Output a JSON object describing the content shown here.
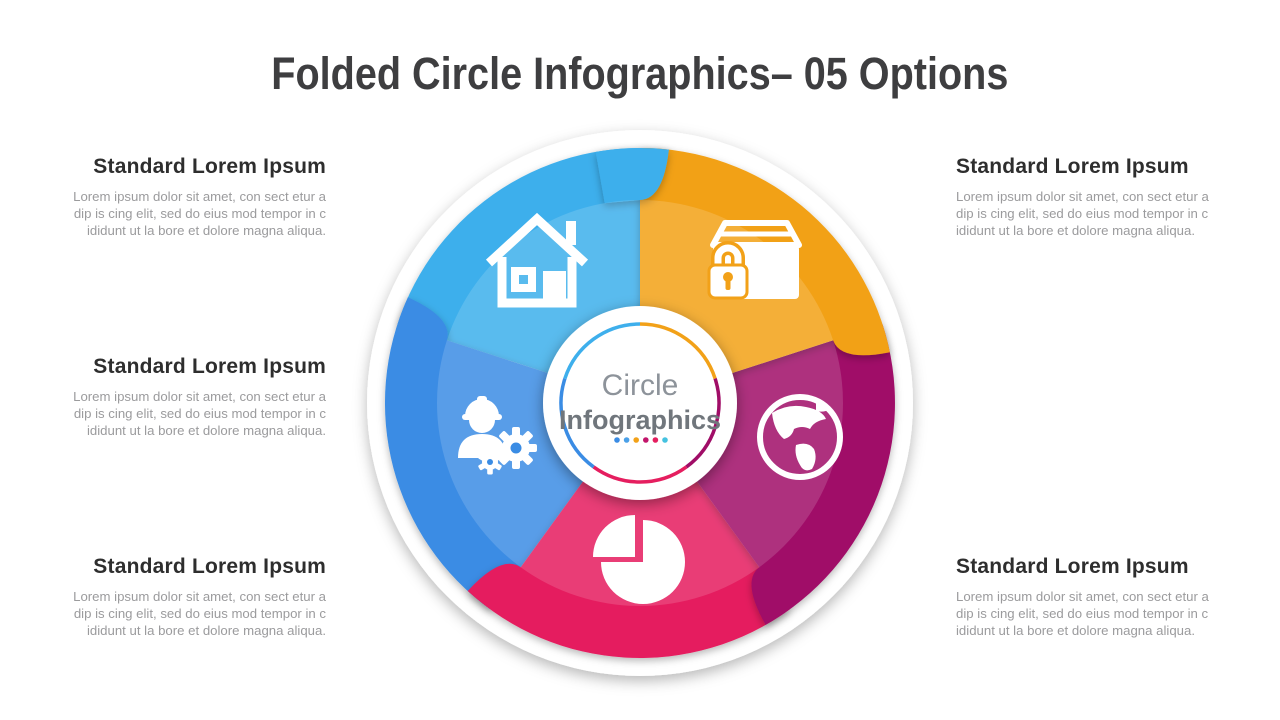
{
  "slide": {
    "title": "Folded Circle Infographics– 05 Options"
  },
  "center": {
    "line1": "Circle",
    "line2": "Infographics"
  },
  "colors": {
    "lightblue": "#3eafec",
    "orange": "#f2a118",
    "magenta": "#a00d67",
    "crimson": "#e51e5f",
    "blue": "#3a8ce4",
    "white": "#ffffff"
  },
  "dots": [
    "#3a8ce4",
    "#4aa0e8",
    "#f2a118",
    "#c2156b",
    "#e51e5f",
    "#45c2e0"
  ],
  "options": [
    {
      "icon": "house-icon",
      "color": "#3eafec",
      "heading": "Standard Lorem Ipsum",
      "body": "Lorem ipsum dolor sit  amet, con sect etur a dip  is cing elit,  sed do eius mod tempor in c ididunt ut la bore et dolore magna aliqua."
    },
    {
      "icon": "secure-package-icon",
      "color": "#f2a118",
      "heading": "Standard Lorem Ipsum",
      "body": "Lorem ipsum dolor sit  amet, con sect etur a dip  is cing elit,  sed do eius mod tempor in c ididunt ut la bore et dolore magna aliqua."
    },
    {
      "icon": "globe-icon",
      "color": "#a00d67",
      "heading": "Standard Lorem Ipsum",
      "body": "Lorem ipsum dolor sit  amet, con sect etur a dip  is cing elit,  sed do eius mod tempor in c ididunt ut la bore et dolore magna aliqua."
    },
    {
      "icon": "pie-chart-icon",
      "color": "#e51e5f",
      "heading": "Standard Lorem Ipsum",
      "body": "Lorem ipsum dolor sit  amet, con sect etur a dip  is cing elit,  sed do eius mod tempor in c ididunt ut la bore et dolore magna aliqua."
    },
    {
      "icon": "engineer-gear-icon",
      "color": "#3a8ce4",
      "heading": "Standard Lorem Ipsum",
      "body": "Lorem ipsum dolor sit  amet, con sect etur a dip  is cing elit,  sed do eius mod tempor in c ididunt ut la bore et dolore magna aliqua."
    }
  ]
}
